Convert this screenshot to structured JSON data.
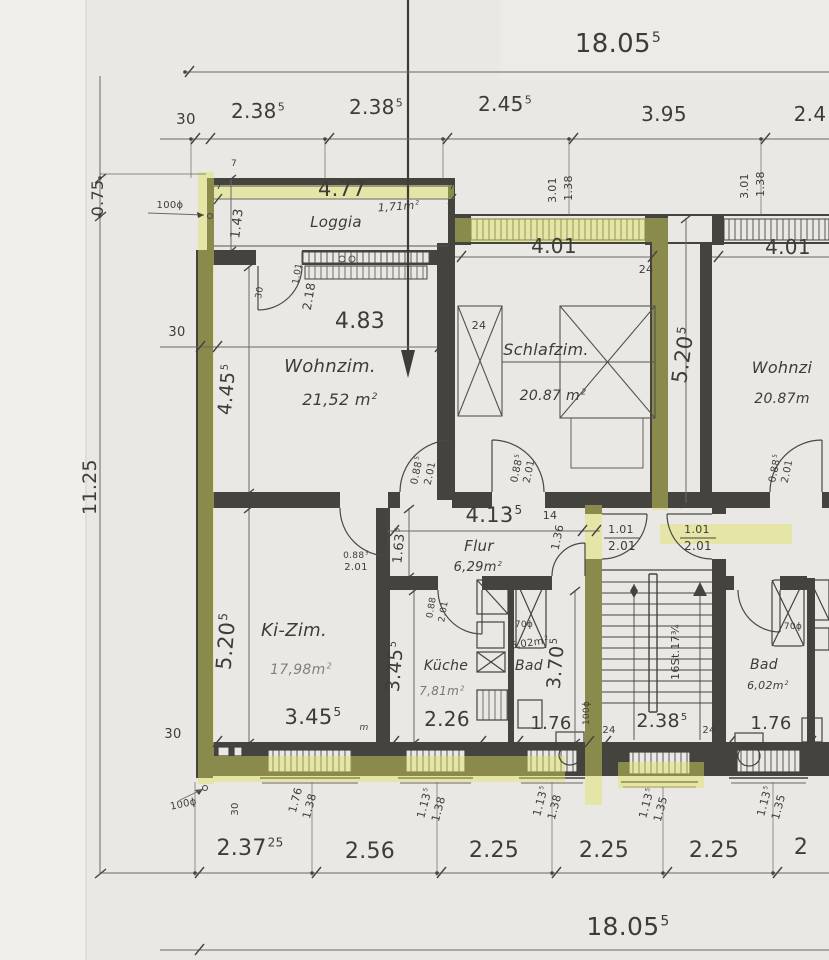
{
  "meta": {
    "title": "Hand-drawn floor plan scan – apartment level with Loggia, Wohnzimmer, Schlafzimmer, Flur, Ki-Zim., Küche, Bad and stairwell",
    "type": "architectural-floor-plan"
  },
  "colors": {
    "paper": "#eae8e4",
    "paper_margin": "#f1f0ec",
    "ink": "#45433e",
    "pencil": "#6b6965",
    "text": "#3e3c37",
    "highlighter": "#dde35e"
  },
  "rooms": [
    {
      "name": "Loggia",
      "area": "1,71m²"
    },
    {
      "name": "Wohnzim.",
      "area": "21,52 m²"
    },
    {
      "name": "Schlafzim.",
      "area": "20.87 m²"
    },
    {
      "name": "Flur",
      "area": "6,29m²"
    },
    {
      "name": "Ki-Zim.",
      "area": "17,98m²"
    },
    {
      "name": "Küche",
      "area": "7,81m²"
    },
    {
      "name": "Bad",
      "area": "6,02m²"
    },
    {
      "name": "Wohnzi (right unit)",
      "area": "20.87m"
    },
    {
      "name": "Bad (right unit)",
      "area": "6,02m²"
    }
  ],
  "dimension_chains": {
    "overall_width_top": "18.05⁵",
    "overall_width_bottom": "18.05⁵",
    "overall_height_left": "11.25",
    "loggia_offset_left": "0.75",
    "top_row": [
      "30",
      "2.38⁵",
      "2.38⁵",
      "2.45⁵",
      "3.95",
      "2.4…"
    ],
    "bottom_row": [
      "2.37²⁵",
      "2.56",
      "2.25",
      "2.25",
      "2.25",
      "2…"
    ],
    "interior_widths": [
      "4.77",
      "4.83",
      "4.01",
      "4.01",
      "4.13⁵",
      "3.45⁵",
      "2.26",
      "1.76",
      "2.38⁵",
      "1.76"
    ],
    "interior_heights": [
      "1.43",
      "4.45⁵",
      "5.20⁵",
      "1.63⁵",
      "5.20⁵",
      "3.45⁵",
      "3.70⁵"
    ],
    "windows_top": [
      "3.01/1.38",
      "3.01/1.38"
    ],
    "windows_bottom": [
      "1.76/1.38",
      "1.13⁵/1.38",
      "1.13⁵/1.38",
      "1.13⁵/1.35",
      "1.13⁵/1.35"
    ],
    "doors": [
      "0.88⁵/2.01",
      "1.01/2.01",
      "2.18"
    ],
    "stairs_note": "16St.17¾",
    "pipe_notes": [
      "100ϕ",
      "70ϕ"
    ],
    "wall_thickness_notes": [
      "30",
      "24",
      "14",
      "7"
    ]
  },
  "labels": [
    {
      "n": "overall-top",
      "t": "18.05",
      "s": "5",
      "x": 618,
      "y": 52,
      "fs": 26
    },
    {
      "n": "toprow-30",
      "t": "30",
      "x": 186,
      "y": 124,
      "fs": 15
    },
    {
      "n": "toprow-238a",
      "t": "2.38",
      "s": "5",
      "x": 258,
      "y": 118,
      "fs": 20
    },
    {
      "n": "toprow-238b",
      "t": "2.38",
      "s": "5",
      "x": 376,
      "y": 114,
      "fs": 20
    },
    {
      "n": "toprow-245",
      "t": "2.45",
      "s": "5",
      "x": 505,
      "y": 111,
      "fs": 20
    },
    {
      "n": "toprow-395",
      "t": "3.95",
      "x": 664,
      "y": 121,
      "fs": 20
    },
    {
      "n": "toprow-24cut",
      "t": "2.4",
      "x": 810,
      "y": 121,
      "fs": 20
    },
    {
      "n": "left-075",
      "t": "0.75",
      "x": 103,
      "y": 198,
      "fs": 16,
      "r": -90
    },
    {
      "n": "left-100phi",
      "t": "100ϕ",
      "x": 170,
      "y": 208,
      "fs": 10
    },
    {
      "n": "left-1125",
      "t": "11.25",
      "x": 96,
      "y": 487,
      "fs": 19,
      "r": -90
    },
    {
      "n": "left-30-mid",
      "t": "30",
      "x": 177,
      "y": 336,
      "fs": 13
    },
    {
      "n": "left-30-low",
      "t": "30",
      "x": 173,
      "y": 738,
      "fs": 13
    },
    {
      "n": "bl-100phi",
      "t": "100ϕ",
      "x": 184,
      "y": 807,
      "fs": 10,
      "r": -12
    },
    {
      "n": "bl-30",
      "t": "30",
      "x": 238,
      "y": 809,
      "fs": 10,
      "r": -90
    },
    {
      "n": "loggia-477",
      "t": "4.77",
      "x": 342,
      "y": 196,
      "fs": 21
    },
    {
      "n": "loggia-name",
      "t": "Loggia",
      "x": 336,
      "y": 227,
      "fs": 15,
      "it": 1
    },
    {
      "n": "loggia-area",
      "t": "1,71m",
      "s": "2",
      "x": 399,
      "y": 210,
      "fs": 11,
      "r": -4,
      "it": 1
    },
    {
      "n": "loggia-143",
      "t": "1.43",
      "x": 241,
      "y": 224,
      "fs": 13,
      "r": -83
    },
    {
      "n": "wallmark-7a",
      "t": "7",
      "x": 234,
      "y": 166,
      "fs": 9
    },
    {
      "n": "wallmark-7b",
      "t": "7",
      "x": 219,
      "y": 189,
      "fs": 9
    },
    {
      "n": "wallmark-7c",
      "t": "7",
      "x": 452,
      "y": 189,
      "fs": 9
    },
    {
      "n": "loggiadoor-101",
      "t": "1.01",
      "x": 300,
      "y": 274,
      "fs": 9,
      "r": -80
    },
    {
      "n": "loggiadoor-218",
      "t": "2.18",
      "x": 313,
      "y": 297,
      "fs": 12,
      "r": -80
    },
    {
      "n": "loggiadoor-30",
      "t": "30",
      "x": 262,
      "y": 293,
      "fs": 9,
      "r": -80
    },
    {
      "n": "win-l-301",
      "t": "3.01",
      "x": 556,
      "y": 190,
      "fs": 11,
      "r": -90
    },
    {
      "n": "win-l-138",
      "t": "1.38",
      "x": 572,
      "y": 188,
      "fs": 11,
      "r": -90
    },
    {
      "n": "dim-401-l",
      "t": "4.01",
      "x": 554,
      "y": 253,
      "fs": 20
    },
    {
      "n": "win-r-301",
      "t": "3.01",
      "x": 748,
      "y": 186,
      "fs": 11,
      "r": -90
    },
    {
      "n": "win-r-138",
      "t": "1.38",
      "x": 764,
      "y": 184,
      "fs": 11,
      "r": -90
    },
    {
      "n": "dim-401-r",
      "t": "4.01",
      "x": 788,
      "y": 254,
      "fs": 20
    },
    {
      "n": "wall-24-a",
      "t": "24",
      "x": 646,
      "y": 273,
      "fs": 11
    },
    {
      "n": "wall-24-b",
      "t": "24",
      "x": 479,
      "y": 329,
      "fs": 11
    },
    {
      "n": "dim-483",
      "t": "4.83",
      "x": 360,
      "y": 328,
      "fs": 22
    },
    {
      "n": "wohnzim-name",
      "t": "Wohnzim.",
      "x": 330,
      "y": 372,
      "fs": 18,
      "it": 1
    },
    {
      "n": "wohnzim-area",
      "t": "21,52 m",
      "s": "2",
      "x": 340,
      "y": 405,
      "fs": 16,
      "it": 1
    },
    {
      "n": "dim-445",
      "t": "4.45",
      "s": "5",
      "x": 233,
      "y": 390,
      "fs": 19,
      "r": -85
    },
    {
      "n": "schlafzim-name",
      "t": "Schlafzim.",
      "x": 546,
      "y": 355,
      "fs": 16,
      "it": 1
    },
    {
      "n": "schlafzim-area",
      "t": "20.87 m",
      "s": "2",
      "x": 553,
      "y": 400,
      "fs": 14,
      "it": 1
    },
    {
      "n": "dim-520-r",
      "t": "5.20",
      "s": "5",
      "x": 690,
      "y": 356,
      "fs": 21,
      "r": -82
    },
    {
      "n": "wohnzi-r-name",
      "t": "Wohnzi",
      "x": 782,
      "y": 373,
      "fs": 16,
      "it": 1
    },
    {
      "n": "wohnzi-r-area",
      "t": "20.87m",
      "x": 782,
      "y": 403,
      "fs": 14,
      "it": 1
    },
    {
      "n": "dim-413",
      "t": "4.13",
      "s": "5",
      "x": 494,
      "y": 522,
      "fs": 21
    },
    {
      "n": "wall-14",
      "t": "14",
      "x": 550,
      "y": 519,
      "fs": 11
    },
    {
      "n": "dim-136",
      "t": "1.36",
      "x": 561,
      "y": 538,
      "fs": 11,
      "r": -78
    },
    {
      "n": "flur-name",
      "t": "Flur",
      "x": 479,
      "y": 551,
      "fs": 15,
      "it": 1
    },
    {
      "n": "flur-area",
      "t": "6,29m",
      "s": "2",
      "x": 478,
      "y": 571,
      "fs": 13,
      "it": 1
    },
    {
      "n": "dim-163",
      "t": "1.63",
      "s": "5",
      "x": 403,
      "y": 546,
      "fs": 13,
      "r": -85
    },
    {
      "n": "door-wz-088",
      "t": "0.88",
      "s": "5",
      "x": 420,
      "y": 471,
      "fs": 10,
      "r": -78
    },
    {
      "n": "door-wz-201",
      "t": "2.01",
      "x": 433,
      "y": 474,
      "fs": 10,
      "r": -78
    },
    {
      "n": "door-sz-088",
      "t": "0.88",
      "s": "5",
      "x": 520,
      "y": 469,
      "fs": 10,
      "r": -78
    },
    {
      "n": "door-sz-201",
      "t": "2.01",
      "x": 532,
      "y": 472,
      "fs": 10,
      "r": -78
    },
    {
      "n": "entr-l-101",
      "t": "1.01",
      "x": 621,
      "y": 533,
      "fs": 11
    },
    {
      "n": "entr-l-201",
      "t": "2.01",
      "x": 622,
      "y": 550,
      "fs": 12
    },
    {
      "n": "entr-r-101",
      "t": "1.01",
      "x": 697,
      "y": 533,
      "fs": 11
    },
    {
      "n": "entr-r-201",
      "t": "2.01",
      "x": 698,
      "y": 550,
      "fs": 12
    },
    {
      "n": "door-rr-088",
      "t": "0.88",
      "s": "5",
      "x": 778,
      "y": 469,
      "fs": 10,
      "r": -78
    },
    {
      "n": "door-rr-201",
      "t": "2.01",
      "x": 790,
      "y": 472,
      "fs": 10,
      "r": -78
    },
    {
      "n": "door-kz-088",
      "t": "0.88",
      "s": "5",
      "x": 356,
      "y": 558,
      "fs": 9
    },
    {
      "n": "door-kz-201",
      "t": "2.01",
      "x": 356,
      "y": 570,
      "fs": 10
    },
    {
      "n": "door-ku-088",
      "t": "0.88",
      "x": 434,
      "y": 608,
      "fs": 9,
      "r": -80
    },
    {
      "n": "door-ku-201",
      "t": "2.01",
      "x": 446,
      "y": 612,
      "fs": 9,
      "r": -80
    },
    {
      "n": "kizim-name",
      "t": "Ki-Zim.",
      "x": 294,
      "y": 636,
      "fs": 18,
      "it": 1
    },
    {
      "n": "kizim-area",
      "t": "17,98m",
      "s": "2",
      "x": 301,
      "y": 674,
      "fs": 14,
      "it": 1,
      "op": 0.6
    },
    {
      "n": "dim-520-l",
      "t": "5.20",
      "s": "5",
      "x": 233,
      "y": 642,
      "fs": 21,
      "r": -85
    },
    {
      "n": "dim-345-b",
      "t": "3.45",
      "s": "5",
      "x": 313,
      "y": 724,
      "fs": 21
    },
    {
      "n": "dim-345-m",
      "t": "m",
      "x": 364,
      "y": 730,
      "fs": 9,
      "it": 1
    },
    {
      "n": "dim-345-k",
      "t": "3.45",
      "s": "5",
      "x": 401,
      "y": 667,
      "fs": 19,
      "r": -85
    },
    {
      "n": "kueche-name",
      "t": "Küche",
      "x": 446,
      "y": 670,
      "fs": 14,
      "it": 1
    },
    {
      "n": "kueche-area",
      "t": "7,81m",
      "s": "2",
      "x": 442,
      "y": 695,
      "fs": 12,
      "it": 1,
      "op": 0.65
    },
    {
      "n": "dim-226",
      "t": "2.26",
      "x": 447,
      "y": 726,
      "fs": 20
    },
    {
      "n": "bad-l-70phi",
      "t": "70ϕ",
      "x": 524,
      "y": 627,
      "fs": 9
    },
    {
      "n": "bad-l-area",
      "t": "6,02m",
      "s": "2",
      "x": 530,
      "y": 646,
      "fs": 10,
      "r": -8
    },
    {
      "n": "bad-l-name",
      "t": "Bad",
      "x": 529,
      "y": 670,
      "fs": 14,
      "it": 1
    },
    {
      "n": "dim-370",
      "t": "3.70",
      "s": "5",
      "x": 562,
      "y": 664,
      "fs": 19,
      "r": -85
    },
    {
      "n": "dim-176-l",
      "t": "1.76",
      "x": 551,
      "y": 729,
      "fs": 18
    },
    {
      "n": "mid-100phi",
      "t": "100ϕ",
      "x": 589,
      "y": 713,
      "fs": 9,
      "r": -90
    },
    {
      "n": "stairs-note",
      "t": "16St.17¾",
      "x": 679,
      "y": 652,
      "fs": 11,
      "r": -90
    },
    {
      "n": "dim-238-st",
      "t": "2.38",
      "s": "5",
      "x": 662,
      "y": 727,
      "fs": 19
    },
    {
      "n": "wall-24-st-l",
      "t": "24",
      "x": 609,
      "y": 733,
      "fs": 10
    },
    {
      "n": "wall-24-st-r",
      "t": "24",
      "x": 709,
      "y": 733,
      "fs": 10
    },
    {
      "n": "bad-r-70phi",
      "t": "70ϕ",
      "x": 793,
      "y": 629,
      "fs": 9
    },
    {
      "n": "bad-r-name",
      "t": "Bad",
      "x": 764,
      "y": 669,
      "fs": 14,
      "it": 1
    },
    {
      "n": "bad-r-area",
      "t": "6,02m",
      "s": "2",
      "x": 768,
      "y": 689,
      "fs": 11,
      "it": 1
    },
    {
      "n": "dim-176-r",
      "t": "1.76",
      "x": 771,
      "y": 729,
      "fs": 18
    },
    {
      "n": "bwin1-176",
      "t": "1.76",
      "x": 299,
      "y": 801,
      "fs": 11,
      "r": -75
    },
    {
      "n": "bwin1-138",
      "t": "1.38",
      "x": 313,
      "y": 807,
      "fs": 11,
      "r": -75
    },
    {
      "n": "bwin2-113",
      "t": "1.13",
      "s": "5",
      "x": 428,
      "y": 804,
      "fs": 11,
      "r": -75
    },
    {
      "n": "bwin2-138",
      "t": "1.38",
      "x": 442,
      "y": 810,
      "fs": 11,
      "r": -75
    },
    {
      "n": "bwin3-113",
      "t": "1.13",
      "s": "5",
      "x": 544,
      "y": 802,
      "fs": 11,
      "r": -75
    },
    {
      "n": "bwin3-138",
      "t": "1.38",
      "x": 558,
      "y": 808,
      "fs": 11,
      "r": -75
    },
    {
      "n": "bwin4-113",
      "t": "1.13",
      "s": "5",
      "x": 650,
      "y": 804,
      "fs": 11,
      "r": -75
    },
    {
      "n": "bwin4-135",
      "t": "1.35",
      "x": 664,
      "y": 810,
      "fs": 11,
      "r": -75
    },
    {
      "n": "bwin5-113",
      "t": "1.13",
      "s": "5",
      "x": 768,
      "y": 802,
      "fs": 11,
      "r": -75
    },
    {
      "n": "bwin5-135",
      "t": "1.35",
      "x": 782,
      "y": 808,
      "fs": 11,
      "r": -75
    },
    {
      "n": "botrow-23725",
      "t": "2.37",
      "s": "25",
      "x": 250,
      "y": 855,
      "fs": 22
    },
    {
      "n": "botrow-256",
      "t": "2.56",
      "x": 370,
      "y": 858,
      "fs": 22
    },
    {
      "n": "botrow-225a",
      "t": "2.25",
      "x": 494,
      "y": 857,
      "fs": 22
    },
    {
      "n": "botrow-225b",
      "t": "2.25",
      "x": 604,
      "y": 857,
      "fs": 22
    },
    {
      "n": "botrow-225c",
      "t": "2.25",
      "x": 714,
      "y": 857,
      "fs": 22
    },
    {
      "n": "botrow-2cut",
      "t": "2",
      "x": 801,
      "y": 854,
      "fs": 22
    },
    {
      "n": "overall-bottom",
      "t": "18.05",
      "s": "5",
      "x": 628,
      "y": 935,
      "fs": 25
    }
  ]
}
